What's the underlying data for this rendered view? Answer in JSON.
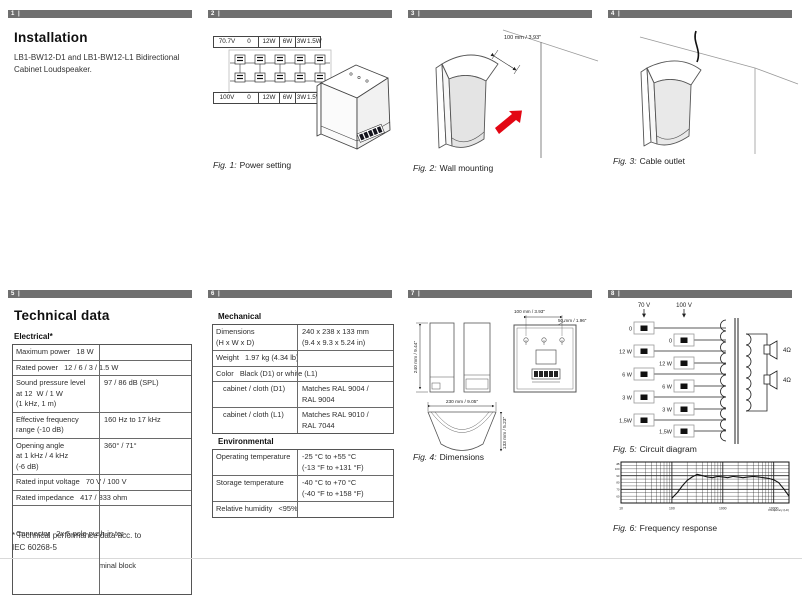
{
  "headers": [
    "1 |",
    "2 |",
    "3 |",
    "4 |",
    "5 |",
    "6 |",
    "7 |",
    "8 |"
  ],
  "colors": {
    "header_bar": "#6f6f6f",
    "arrow_red": "#e30613"
  },
  "p1": {
    "title": "Installation",
    "body": "LB1-BW12-D1 and LB1-BW12-L1 Bidirectional\nCabinet Loudspeaker."
  },
  "p2": {
    "strip_top": [
      "70.7V",
      "0",
      "12W",
      "6W",
      "3W",
      "1.5W"
    ],
    "strip_bottom": [
      "100V",
      "0",
      "12W",
      "6W",
      "3W",
      "1.5W"
    ],
    "fig": "Fig. 1:",
    "cap": "Power setting"
  },
  "p3": {
    "dim": "100 mm / 3.93\"",
    "fig": "Fig. 2:",
    "cap": "Wall mounting"
  },
  "p4": {
    "fig": "Fig. 3:",
    "cap": "Cable outlet"
  },
  "p5": {
    "title": "Technical data",
    "section": "Electrical*",
    "rows": [
      {
        "text": "Maximum power   18 W"
      },
      {
        "text": "Rated power   12 / 6 / 3 / 1.5 W"
      },
      {
        "label": "Sound pressure level\nat 12  W / 1 W\n(1 kHz, 1 m)",
        "value": "97 / 86 dB (SPL)"
      },
      {
        "label": "Effective frequency\nrange (-10 dB)",
        "value": "160 Hz to 17 kHz"
      },
      {
        "label": "Opening angle\nat 1 kHz / 4 kHz\n(-6 dB)",
        "value": "360° / 71°"
      },
      {
        "text": "Rated input voltage   70 V / 100 V"
      },
      {
        "text": "Rated impedance   417 / 833 ohm"
      },
      {
        "line1": "Connector   2x 5-pole push-in ter-",
        "line2": "minal block"
      }
    ],
    "footnote": "* Technical performance data acc. to\nIEC 60268-5"
  },
  "p6": {
    "section1": "Mechanical",
    "mech": [
      {
        "label": "Dimensions\n(H x W x D)",
        "value": "240 x 238 x 133 mm\n(9.4 x 9.3 x 5.24 in)"
      },
      {
        "text": "Weight   1.97 kg (4.34 lb)"
      },
      {
        "text": "Color   Black (D1) or white (L1)"
      },
      {
        "label": "cabinet / cloth (D1)",
        "value": "Matches RAL 9004 /\nRAL 9004"
      },
      {
        "label": "cabinet / cloth (L1)",
        "value": "Matches RAL 9010 /\nRAL 7044"
      }
    ],
    "section2": "Environmental",
    "env": [
      {
        "label": "Operating temperature",
        "value": "-25 °C to +55 °C\n(-13 °F to +131 °F)"
      },
      {
        "label": "Storage temperature",
        "value": "-40 °C to +70 °C\n(-40 °F to +158 °F)"
      },
      {
        "text": "Relative humidity   <95%"
      }
    ]
  },
  "p7": {
    "dims": {
      "height": "240 mm / 9.44\"",
      "holes": "100 mm / 3.93\"",
      "holes2": "50 mm / 1.96\"",
      "width": "230 mm / 9.05\"",
      "depth": "133 mm / 5.23\""
    },
    "fig": "Fig. 4:",
    "cap": "Dimensions"
  },
  "p8": {
    "v70": "70 V",
    "v100": "100 V",
    "taps": [
      "0",
      "12 W",
      "6 W",
      "3 W",
      "1,5W"
    ],
    "ohm1": "4Ω",
    "ohm2": "4Ω",
    "fig5": "Fig. 5:",
    "cap5": "Circuit diagram",
    "fig6": "Fig. 6:",
    "cap6": "Frequency response"
  },
  "chart_data": {
    "type": "line",
    "title": "Frequency response",
    "xlabel": "Frequency (Hz)",
    "ylabel": "dB",
    "x_scale": "log",
    "xlim": [
      10,
      20000
    ],
    "ylim": [
      50,
      110
    ],
    "x_ticks": [
      10,
      100,
      1000,
      10000
    ],
    "y_ticks": [
      50,
      60,
      70,
      80,
      90,
      100,
      110
    ],
    "grid": true,
    "legend": false,
    "x": [
      100,
      130,
      160,
      200,
      250,
      315,
      400,
      500,
      630,
      800,
      1000,
      1250,
      1600,
      2000,
      2500,
      3150,
      4000,
      5000,
      6300,
      8000,
      10000,
      12500,
      16000,
      20000
    ],
    "y": [
      57,
      66,
      75,
      83,
      88,
      92,
      90,
      88,
      87,
      89,
      88,
      87,
      89,
      88,
      87,
      88,
      89,
      88,
      87,
      86,
      84,
      80,
      70,
      60
    ]
  }
}
